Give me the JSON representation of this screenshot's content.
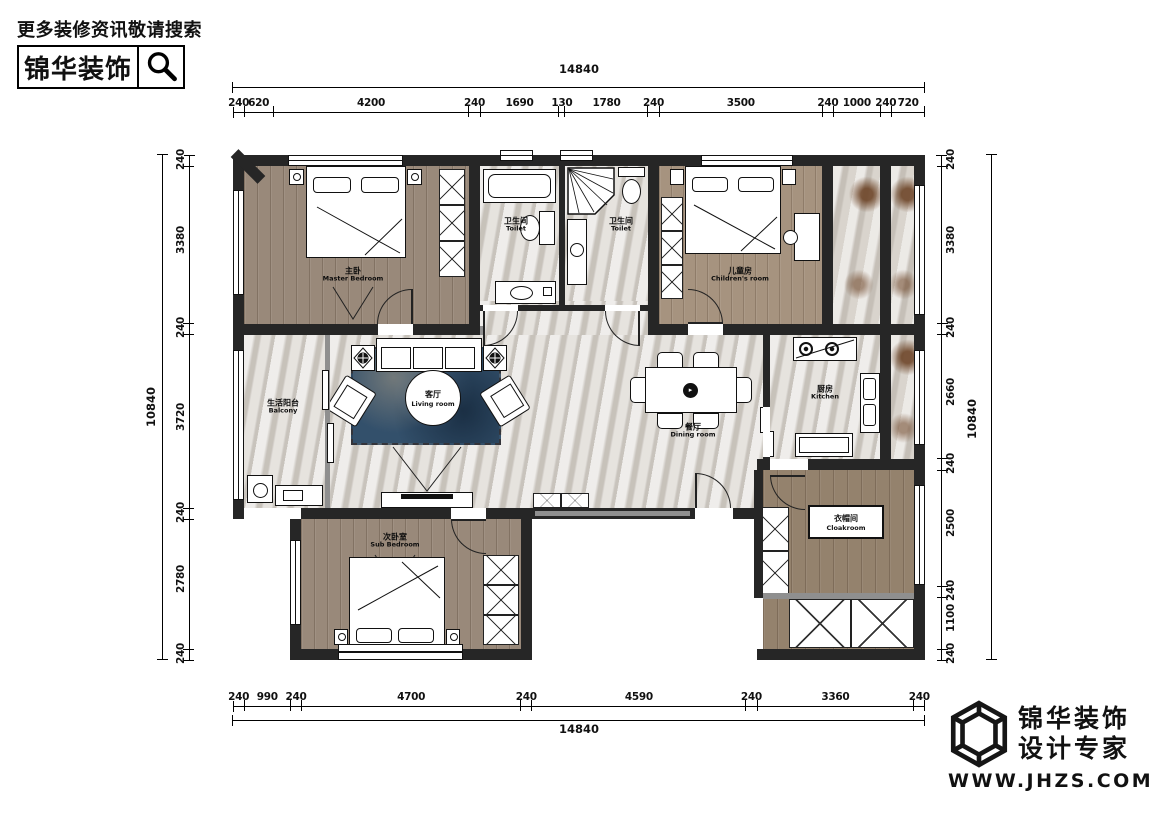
{
  "branding_top": {
    "tagline": "更多装修资讯敬请搜索",
    "logo_text": "锦华装饰",
    "search_icon": "magnifier"
  },
  "branding_bottom": {
    "company": "锦华装饰",
    "slogan": "设计专家",
    "website": "WWW.JHZS.COM",
    "logo_icon": "wireframe-cube"
  },
  "dimensions": {
    "top": {
      "total": "14840",
      "segments": [
        "240",
        "620",
        "4200",
        "240",
        "1690",
        "130",
        "1780",
        "240",
        "3500",
        "240",
        "1000",
        "240",
        "720"
      ]
    },
    "bottom": {
      "total": "14840",
      "segments": [
        "240",
        "990",
        "240",
        "4700",
        "240",
        "4590",
        "240",
        "3360",
        "240"
      ]
    },
    "left": {
      "total": "10840",
      "segments": [
        "240",
        "3380",
        "240",
        "3720",
        "240",
        "2780",
        "240"
      ]
    },
    "right": {
      "total": "10840",
      "segments": [
        "240",
        "3380",
        "240",
        "2660",
        "240",
        "2500",
        "240",
        "1100",
        "240"
      ]
    }
  },
  "rooms": {
    "master_bedroom": {
      "zh": "主卧",
      "en": "Master Bedroom"
    },
    "toilet_left": {
      "zh": "卫生间",
      "en": "Toilet"
    },
    "toilet_right": {
      "zh": "卫生间",
      "en": "Toilet"
    },
    "children_room": {
      "zh": "儿童房",
      "en": "Children's room"
    },
    "balcony": {
      "zh": "生活阳台",
      "en": "Balcony"
    },
    "living_room": {
      "zh": "客厅",
      "en": "Living room"
    },
    "dining_room": {
      "zh": "餐厅",
      "en": "Dining room"
    },
    "kitchen": {
      "zh": "厨房",
      "en": "Kitchen"
    },
    "sub_bedroom": {
      "zh": "次卧室",
      "en": "Sub Bedroom"
    },
    "cloakroom": {
      "zh": "衣帽间",
      "en": "Cloakroom"
    }
  },
  "colors": {
    "wall": "#262626",
    "wall_secondary": "#8f8f8f",
    "wood": "#99897a",
    "marble": "#dcd8d2",
    "rug": "#33506b",
    "balcony_stain": "#6e4526"
  }
}
